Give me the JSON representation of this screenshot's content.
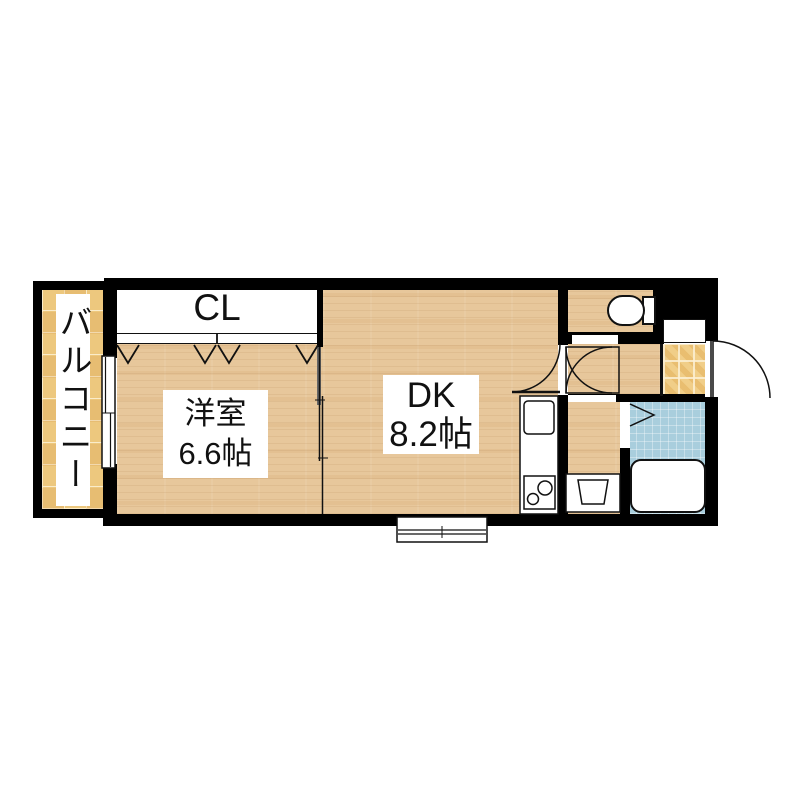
{
  "meta": {
    "type": "Japanese apartment floor plan (1DK)"
  },
  "rooms": {
    "balcony": {
      "label": "バルコニー"
    },
    "closet": {
      "label": "CL"
    },
    "western_room": {
      "name": "洋室",
      "area": "6.6帖"
    },
    "dining_kitchen": {
      "name": "DK",
      "area": "8.2帖"
    }
  },
  "fixtures": [
    "toilet",
    "bathtub",
    "washing-machine-pan",
    "kitchen-sink",
    "gas-stove",
    "entrance-door",
    "interior-door",
    "folding-bath-door",
    "closet-folding-doors",
    "sliding-partition",
    "balcony-window",
    "kitchen-window"
  ],
  "colors": {
    "wall": "#000000",
    "wood": "#e7c79b",
    "tile_balcony": "#edc87e",
    "tile_genkan": "#e9be70",
    "tile_bath": "#a9cedd",
    "outline": "#111111"
  }
}
